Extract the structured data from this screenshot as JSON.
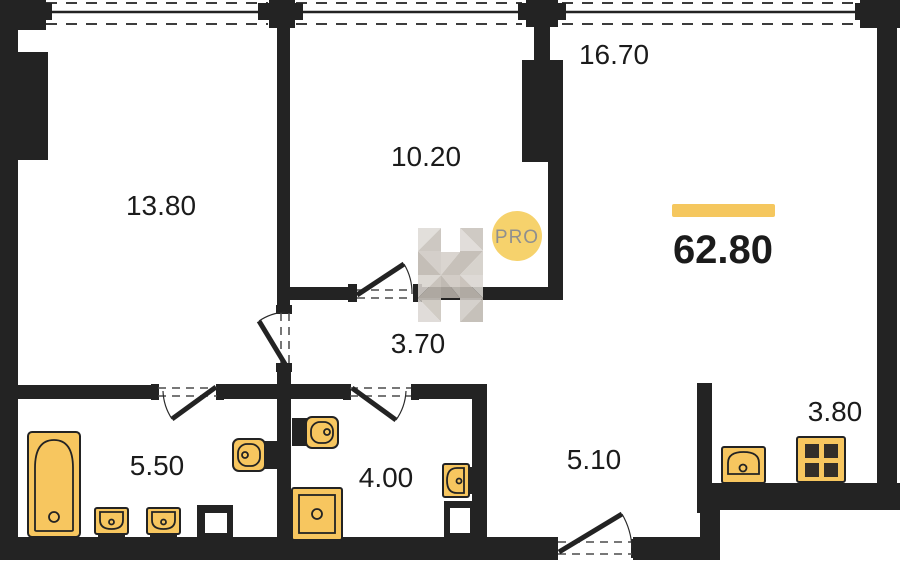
{
  "plan": {
    "total_area": {
      "value": "62.80"
    },
    "badge": {
      "label": "PRO"
    },
    "rooms": [
      {
        "id": "room-13-80",
        "area": "13.80"
      },
      {
        "id": "room-10-20",
        "area": "10.20"
      },
      {
        "id": "room-16-70",
        "area": "16.70"
      },
      {
        "id": "hall-3-70",
        "area": "3.70"
      },
      {
        "id": "bath-5-50",
        "area": "5.50"
      },
      {
        "id": "bath-4-00",
        "area": "4.00"
      },
      {
        "id": "hall-5-10",
        "area": "5.10"
      },
      {
        "id": "niche-3-80",
        "area": "3.80"
      }
    ],
    "fixtures": [
      "bathtub",
      "sink",
      "sink",
      "toilet",
      "shaft",
      "toilet",
      "shower",
      "sink",
      "shaft",
      "kitchen-sink",
      "stove"
    ],
    "colors": {
      "wall": "#232323",
      "fixture": "#F7C65F",
      "accent": "#F5C75E",
      "badge_fill": "#F6D26C",
      "badge_text": "#8F8F8F",
      "label": "#1B1B1B"
    }
  }
}
